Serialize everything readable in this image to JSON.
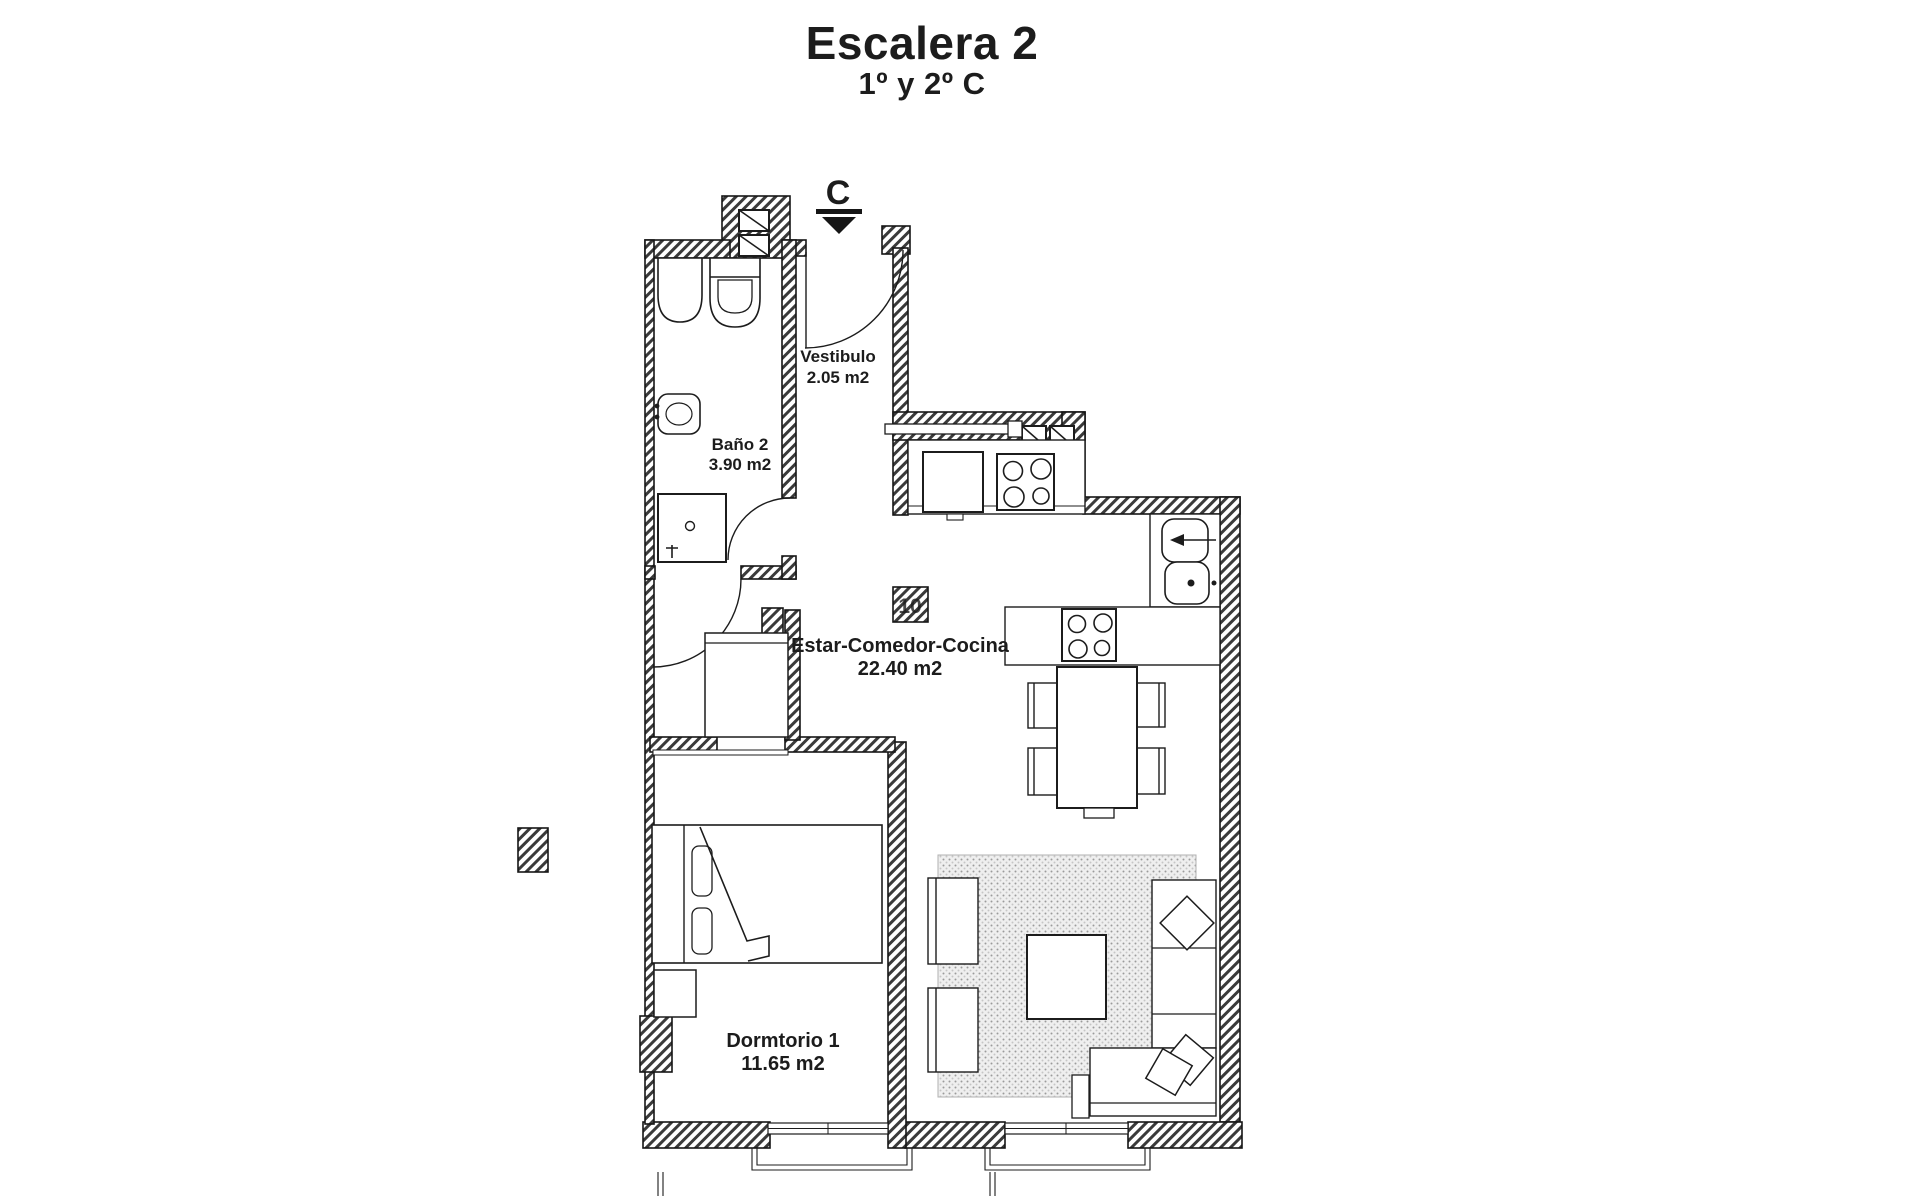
{
  "title": {
    "line1": "Escalera 2",
    "line2": "1º y 2º C"
  },
  "entrance_marker": {
    "label": "C"
  },
  "rooms": {
    "vestibulo": {
      "name": "Vestibulo",
      "area": "2.05 m2"
    },
    "bano2": {
      "name": "Baño 2",
      "area": "3.90 m2"
    },
    "estar_comedor_cocina": {
      "name": "Estar-Comedor-Cocina",
      "area": "22.40 m2"
    },
    "dormitorio1": {
      "name": "Dormtorio 1",
      "area": "11.65 m2"
    }
  },
  "watermark": {
    "text": "10"
  },
  "colors": {
    "ink": "#1c1c1c",
    "paper": "#ffffff",
    "rug_fill": "#efefef",
    "wall_hatch": "#3a3a3a"
  }
}
